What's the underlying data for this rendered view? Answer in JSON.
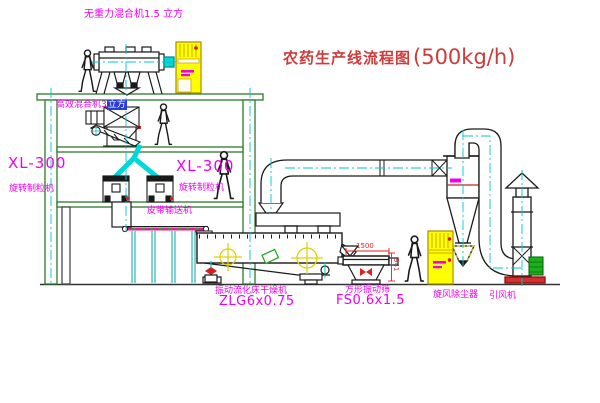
{
  "title": {
    "text": "农药生产线流程图",
    "capacity": "(500kg/h)"
  },
  "labels": {
    "gravity_mixer": "无重力混合机1.5 立方",
    "high_eff_mixer": "高效混合机3",
    "high_eff_mixer_suffix": "立方",
    "granulator_left_model": "XL-300",
    "granulator_left_name": "旋转制粒机",
    "granulator_center_model": "XL-300",
    "granulator_center_name": "旋转制粒机",
    "belt_conveyor": "皮带输送机",
    "dryer_name": "振动流化床干燥机",
    "dryer_model": "ZLG6x0.75",
    "screen_name": "方形振动筛",
    "screen_model": "FS0.6x1.5",
    "cyclone_name": "旋风除尘器",
    "fan_name": "引风机"
  },
  "dimensions": {
    "screen_width": "1500",
    "screen_height": "941"
  },
  "colors": {
    "label": "#ee00ee",
    "title": "#cd3b3b",
    "dim": "#dd2222",
    "structure": "#2d7a2d",
    "centerline": "#00c8c8",
    "cabinet": "#ffff00",
    "machine": "#1a1a1a"
  }
}
